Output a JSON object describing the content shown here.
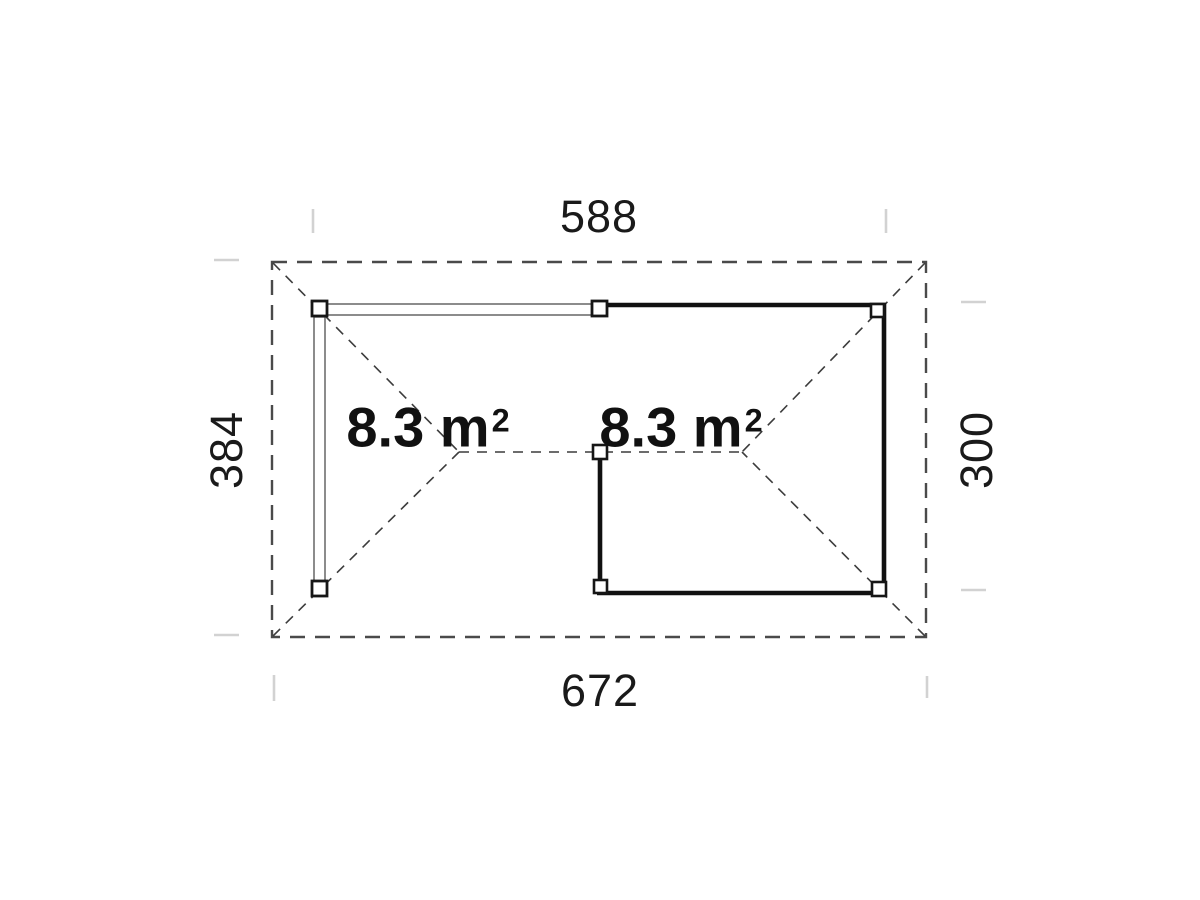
{
  "dimensions": {
    "top": "588",
    "bottom": "672",
    "left": "384",
    "right": "300"
  },
  "areas": {
    "left": {
      "value": "8.3 m",
      "sup": "2"
    },
    "right": {
      "value": "8.3 m",
      "sup": "2"
    }
  },
  "colors": {
    "wall": "#111111",
    "roof_dash": "#4a4a4a",
    "hip_dash": "#3c3c3c",
    "beam_line": "#4f4f4f",
    "tick": "#d2d2d2",
    "text": "#1a1a1a",
    "background": "#ffffff"
  }
}
